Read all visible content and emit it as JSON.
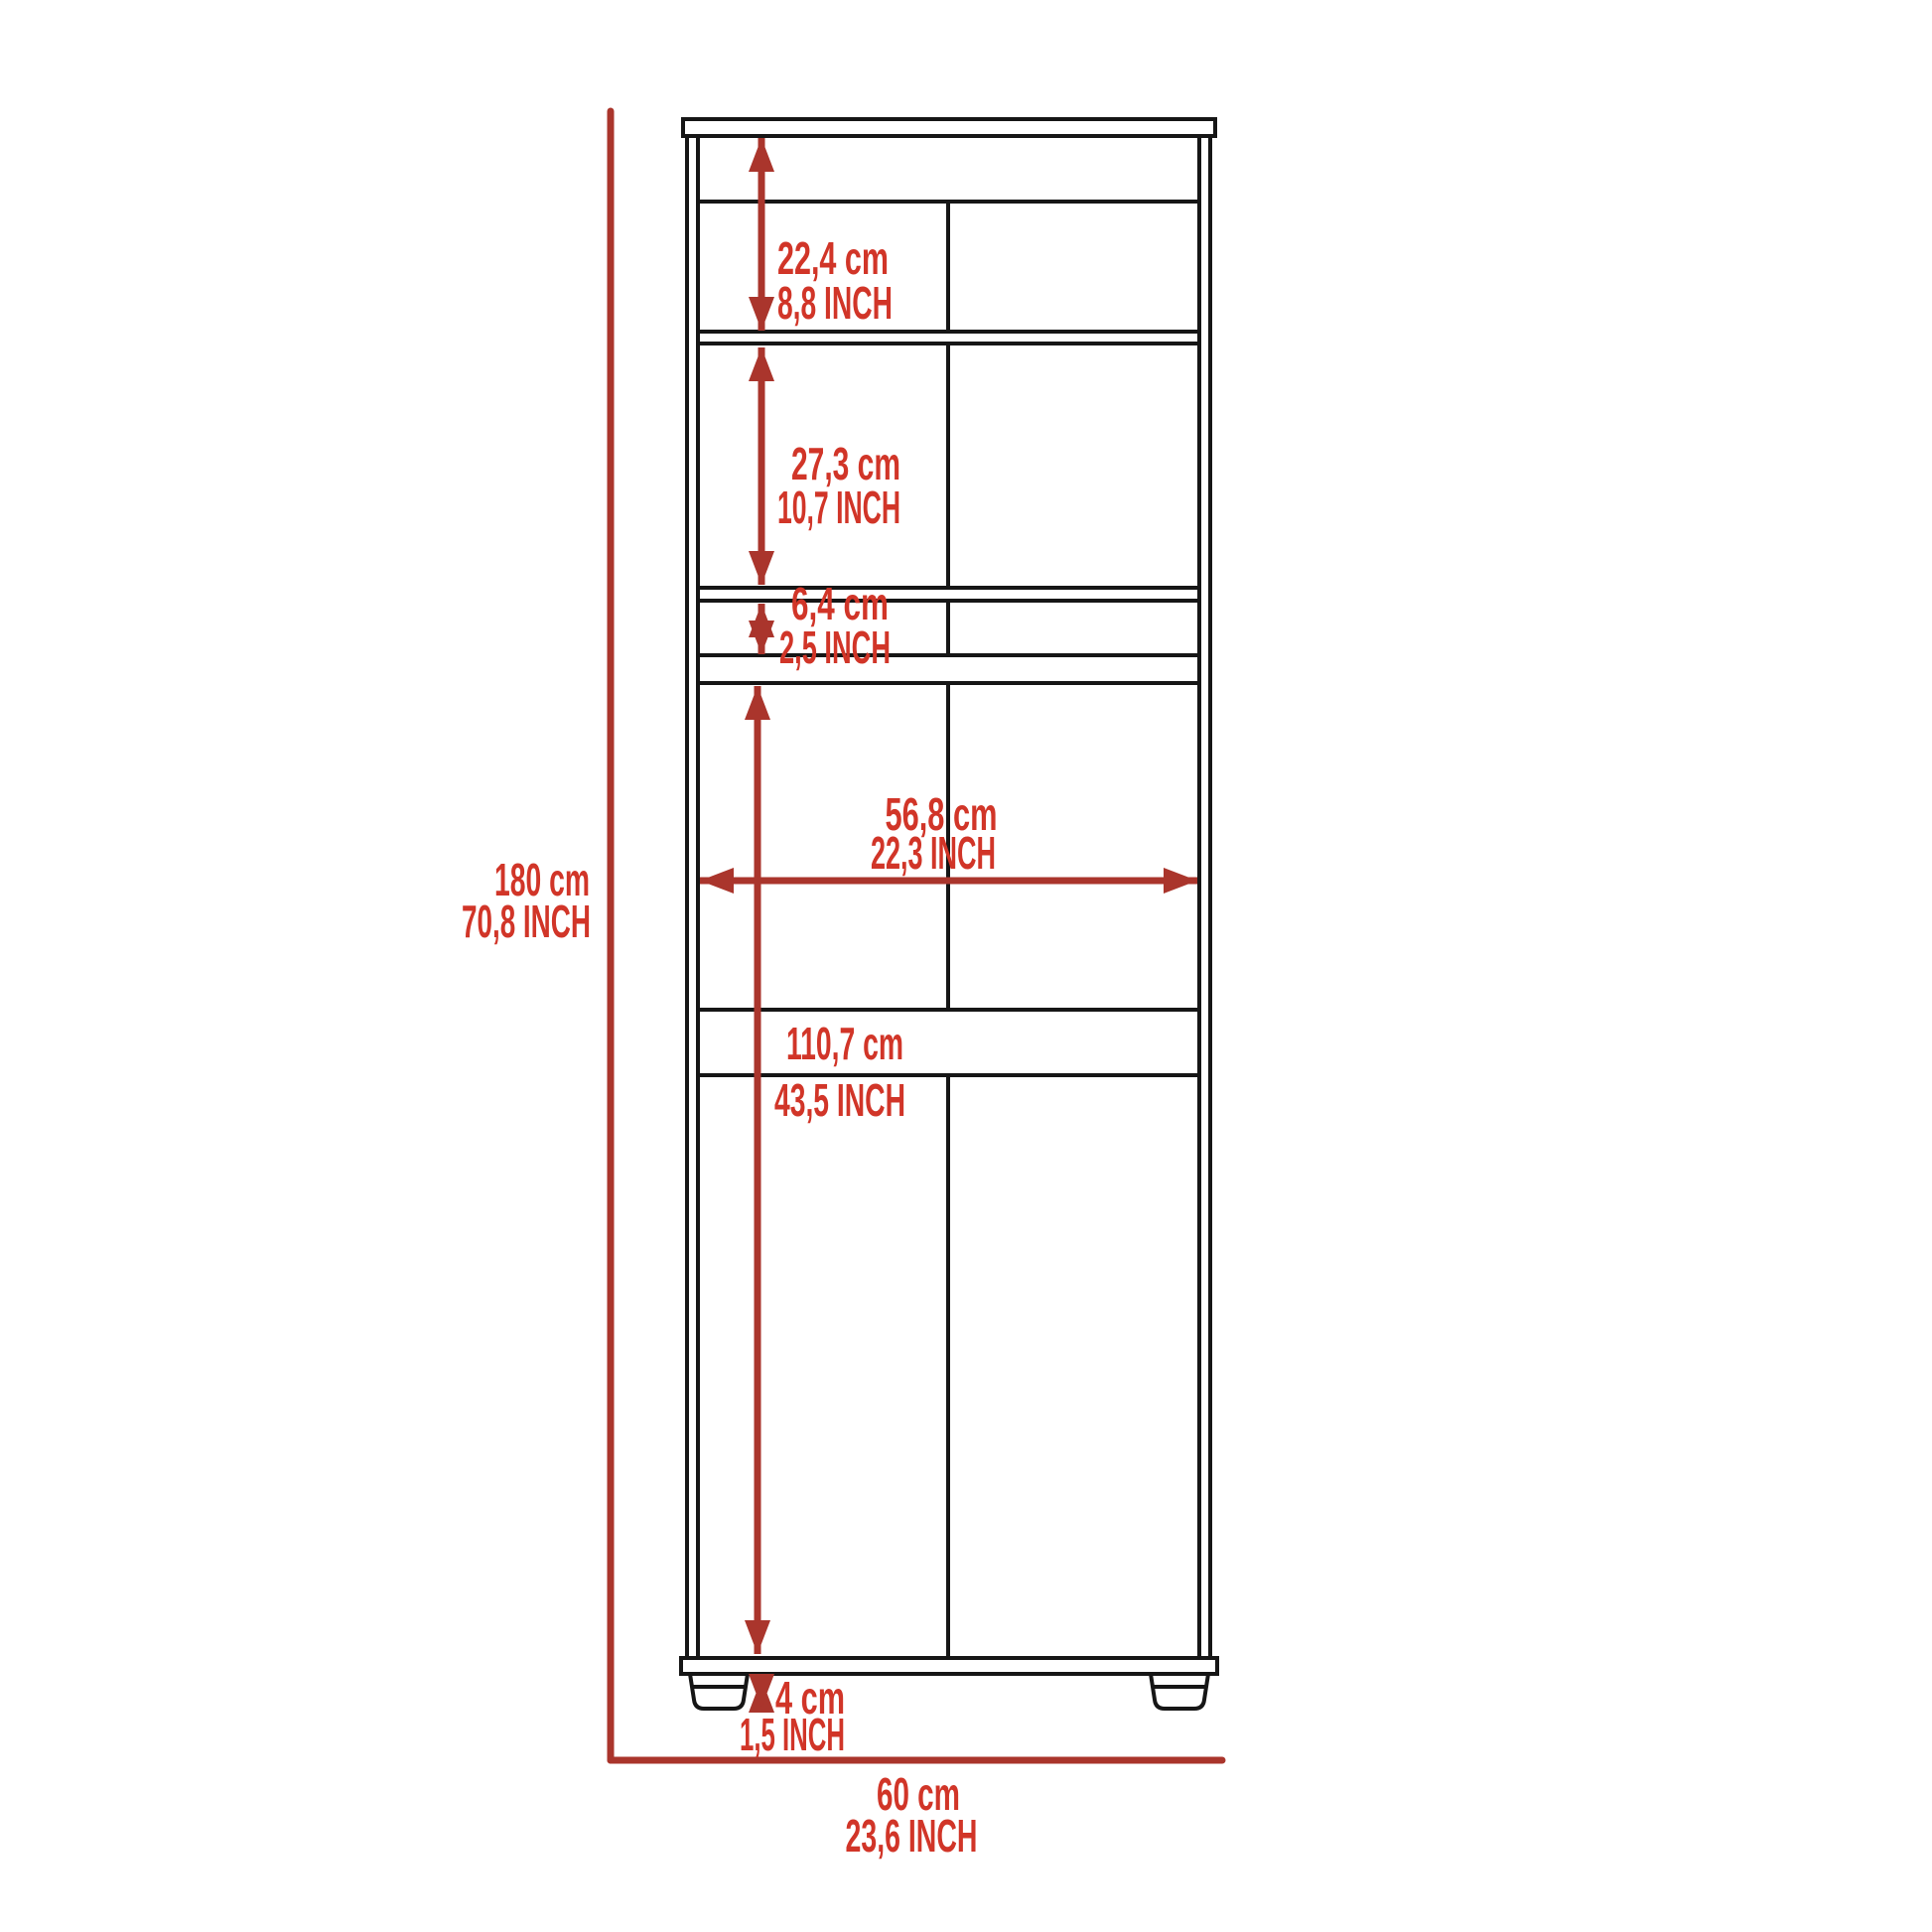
{
  "colors": {
    "dimension_red": "#aa352c",
    "label_red": "#d13528",
    "outline_black": "#161616",
    "background": "#ffffff"
  },
  "labels": {
    "total_height": {
      "cm": "180 cm",
      "inch": "70,8 INCH"
    },
    "top_shelf_height": {
      "cm": "22,4 cm",
      "inch": "8,8 INCH"
    },
    "middle_shelf_height": {
      "cm": "27,3 cm",
      "inch": "10,7 INCH"
    },
    "slot_height": {
      "cm": "6,4 cm",
      "inch": "2,5 INCH"
    },
    "interior_width": {
      "cm": "56,8 cm",
      "inch": "22,3 INCH"
    },
    "lower_cabinet_height": {
      "cm": "110,7 cm",
      "inch": "43,5 INCH"
    },
    "foot_height": {
      "cm": "4 cm",
      "inch": "1,5 INCH"
    },
    "total_width": {
      "cm": "60 cm",
      "inch": "23,6 INCH"
    }
  }
}
